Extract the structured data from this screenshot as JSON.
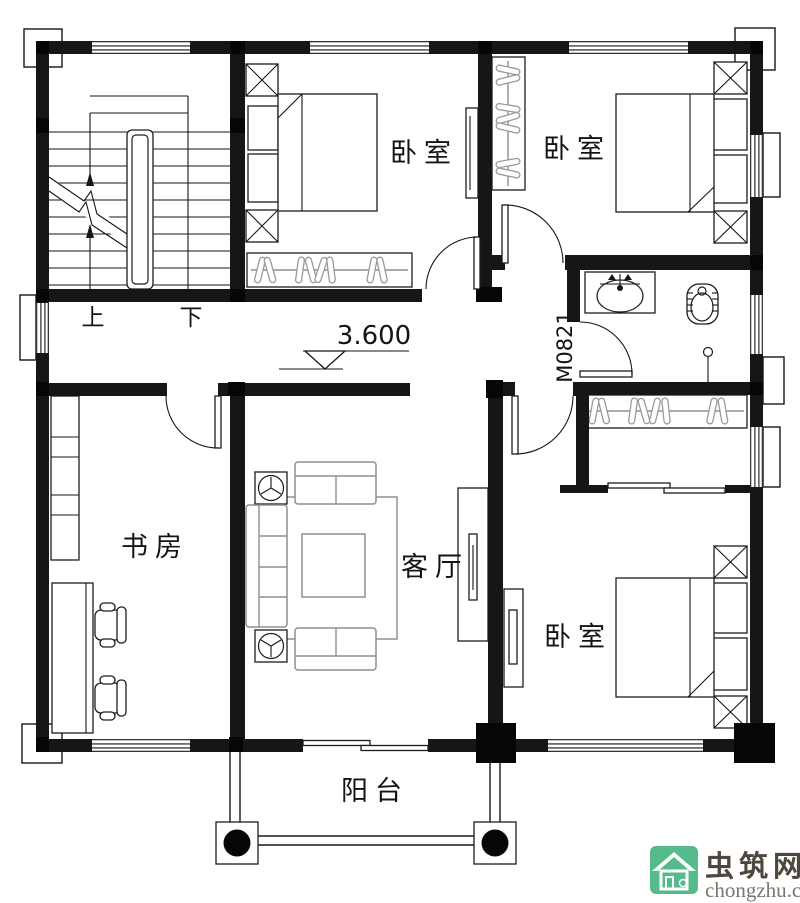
{
  "plan": {
    "rooms": {
      "bedroom_top_left": "卧室",
      "bedroom_top_right": "卧室",
      "bedroom_bottom_right": "卧室",
      "study": "书房",
      "living_room": "客厅",
      "balcony": "阳台"
    },
    "stairs": {
      "up": "上",
      "down": "下"
    },
    "elevation": "3.600",
    "door_code": "M0821"
  },
  "watermark": {
    "site_name": "虫筑网",
    "site_url": "chongzhu.cn",
    "badge_color": "#56bb8b",
    "name_color": "#4d473e",
    "url_color": "#7b766d"
  },
  "colors": {
    "line": "#161616",
    "furniture_gray": "#8f8f8f",
    "background": "#ffffff"
  }
}
